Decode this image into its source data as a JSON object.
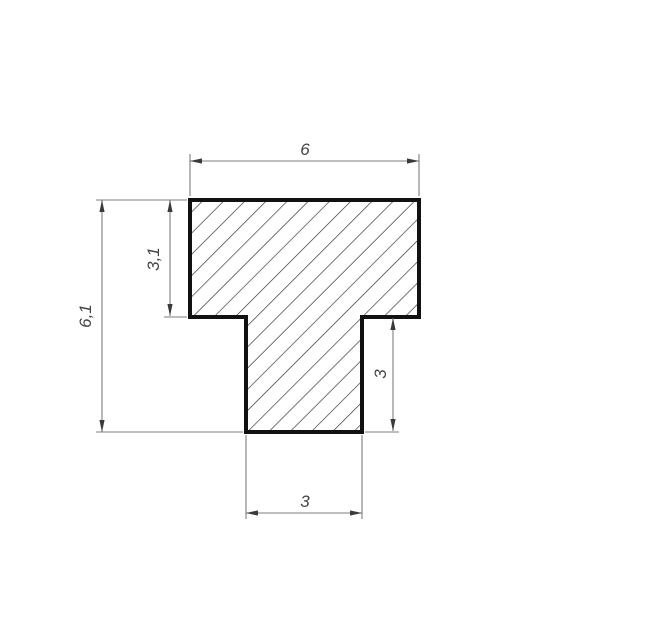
{
  "drawing": {
    "type": "technical-drawing",
    "description": "T-shaped profile cross-section with diagonal hatching and dimension annotations",
    "units_style": "decimal-comma",
    "colors": {
      "background": "#ffffff",
      "outline": "#111111",
      "hatch": "#2a2a2a",
      "dimension_lines": "#7d7d7d",
      "arrowheads": "#3a3a3a",
      "labels": "#444444"
    },
    "dimensions": {
      "top_width": "6",
      "total_height": "6,1",
      "flange_height": "3,1",
      "stem_height": "3",
      "stem_width": "3"
    }
  }
}
